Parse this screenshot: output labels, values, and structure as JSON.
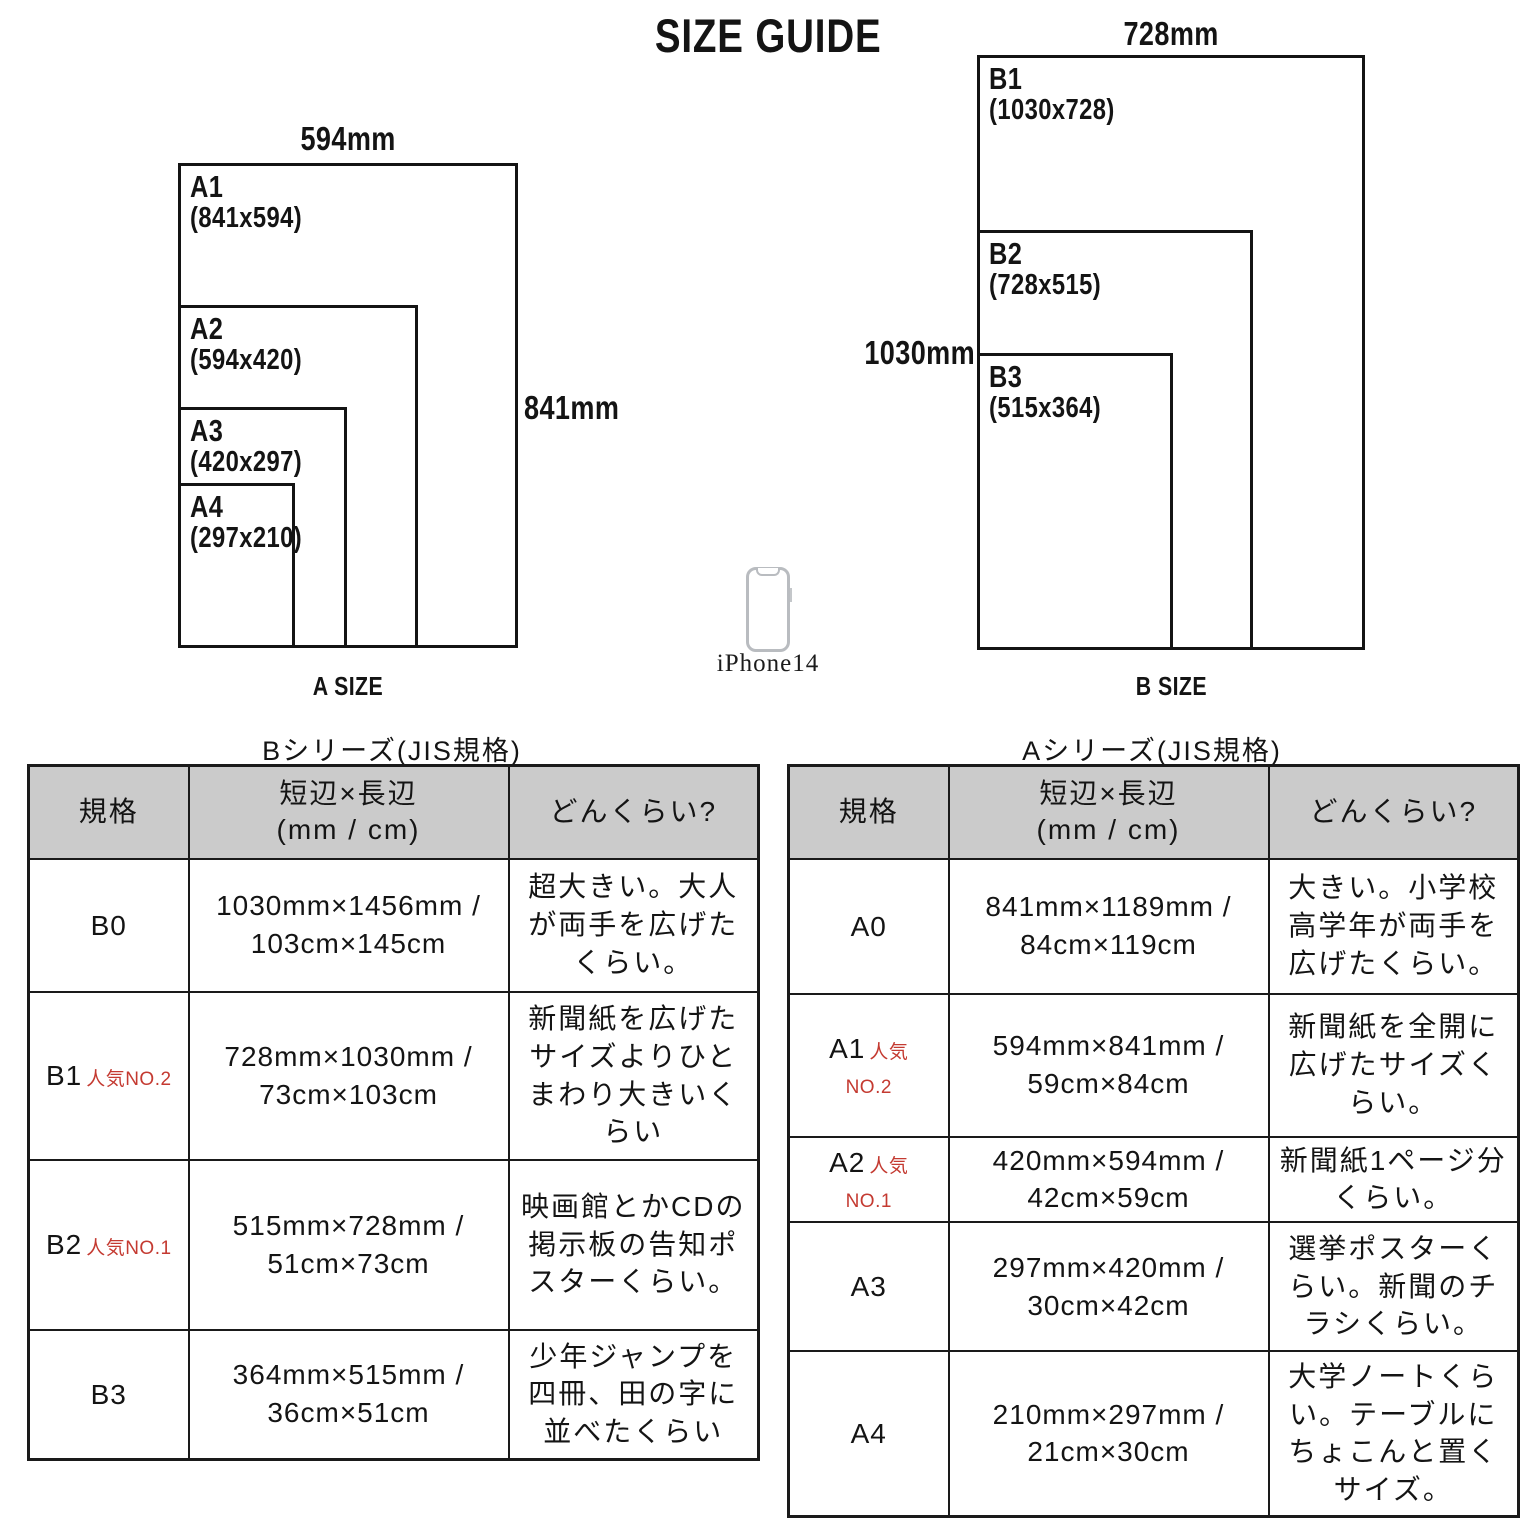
{
  "title": "SIZE GUIDE",
  "diagram_a": {
    "top_dim": "594mm",
    "side_dim": "841mm",
    "caption": "A SIZE",
    "sizes": [
      {
        "name": "A1",
        "dims": "(841x594)"
      },
      {
        "name": "A2",
        "dims": "(594x420)"
      },
      {
        "name": "A3",
        "dims": "(420x297)"
      },
      {
        "name": "A4",
        "dims": "(297x210)"
      }
    ]
  },
  "diagram_b": {
    "top_dim": "728mm",
    "side_dim": "1030mm",
    "caption": "B SIZE",
    "sizes": [
      {
        "name": "B1",
        "dims": "(1030x728)"
      },
      {
        "name": "B2",
        "dims": "(728x515)"
      },
      {
        "name": "B3",
        "dims": "(515x364)"
      }
    ]
  },
  "phone": {
    "label": "iPhone14"
  },
  "table_b": {
    "title": "Bシリーズ(JIS規格)",
    "headers": {
      "col1": "規格",
      "col2_line1": "短辺×長辺",
      "col2_line2": "(mm / cm)",
      "col3": "どんくらい?"
    },
    "rows": [
      {
        "name": "B0",
        "size": "1030mm×1456mm / 103cm×145cm",
        "desc": "超大きい。大人が両手を広げたくらい。"
      },
      {
        "name": "B1",
        "badge": "人気NO.2",
        "size": "728mm×1030mm / 73cm×103cm",
        "desc": "新聞紙を広げたサイズよりひとまわり大きいくらい"
      },
      {
        "name": "B2",
        "badge": "人気NO.1",
        "size": "515mm×728mm / 51cm×73cm",
        "desc": "映画館とかCDの掲示板の告知ポスターくらい。"
      },
      {
        "name": "B3",
        "size": "364mm×515mm / 36cm×51cm",
        "desc": "少年ジャンプを四冊、田の字に並べたくらい"
      }
    ]
  },
  "table_a": {
    "title": "Aシリーズ(JIS規格)",
    "headers": {
      "col1": "規格",
      "col2_line1": "短辺×長辺",
      "col2_line2": "(mm / cm)",
      "col3": "どんくらい?"
    },
    "rows": [
      {
        "name": "A0",
        "size": "841mm×1189mm / 84cm×119cm",
        "desc": "大きい。小学校高学年が両手を広げたくらい。"
      },
      {
        "name": "A1",
        "badge_line1": "人気",
        "badge_line2": "NO.2",
        "size": "594mm×841mm / 59cm×84cm",
        "desc": "新聞紙を全開に広げたサイズくらい。"
      },
      {
        "name": "A2",
        "badge_line1": "人気",
        "badge_line2": "NO.1",
        "size": "420mm×594mm / 42cm×59cm",
        "desc": "新聞紙1ページ分くらい。"
      },
      {
        "name": "A3",
        "size": "297mm×420mm / 30cm×42cm",
        "desc": "選挙ポスターくらい。新聞のチラシくらい。"
      },
      {
        "name": "A4",
        "size": "210mm×297mm / 21cm×30cm",
        "desc": "大学ノートくらい。テーブルにちょこんと置くサイズ。"
      }
    ]
  },
  "colors": {
    "accent_red": "#c43a31",
    "header_bg": "#cbcbcb",
    "line_black": "#1a1a1a"
  }
}
